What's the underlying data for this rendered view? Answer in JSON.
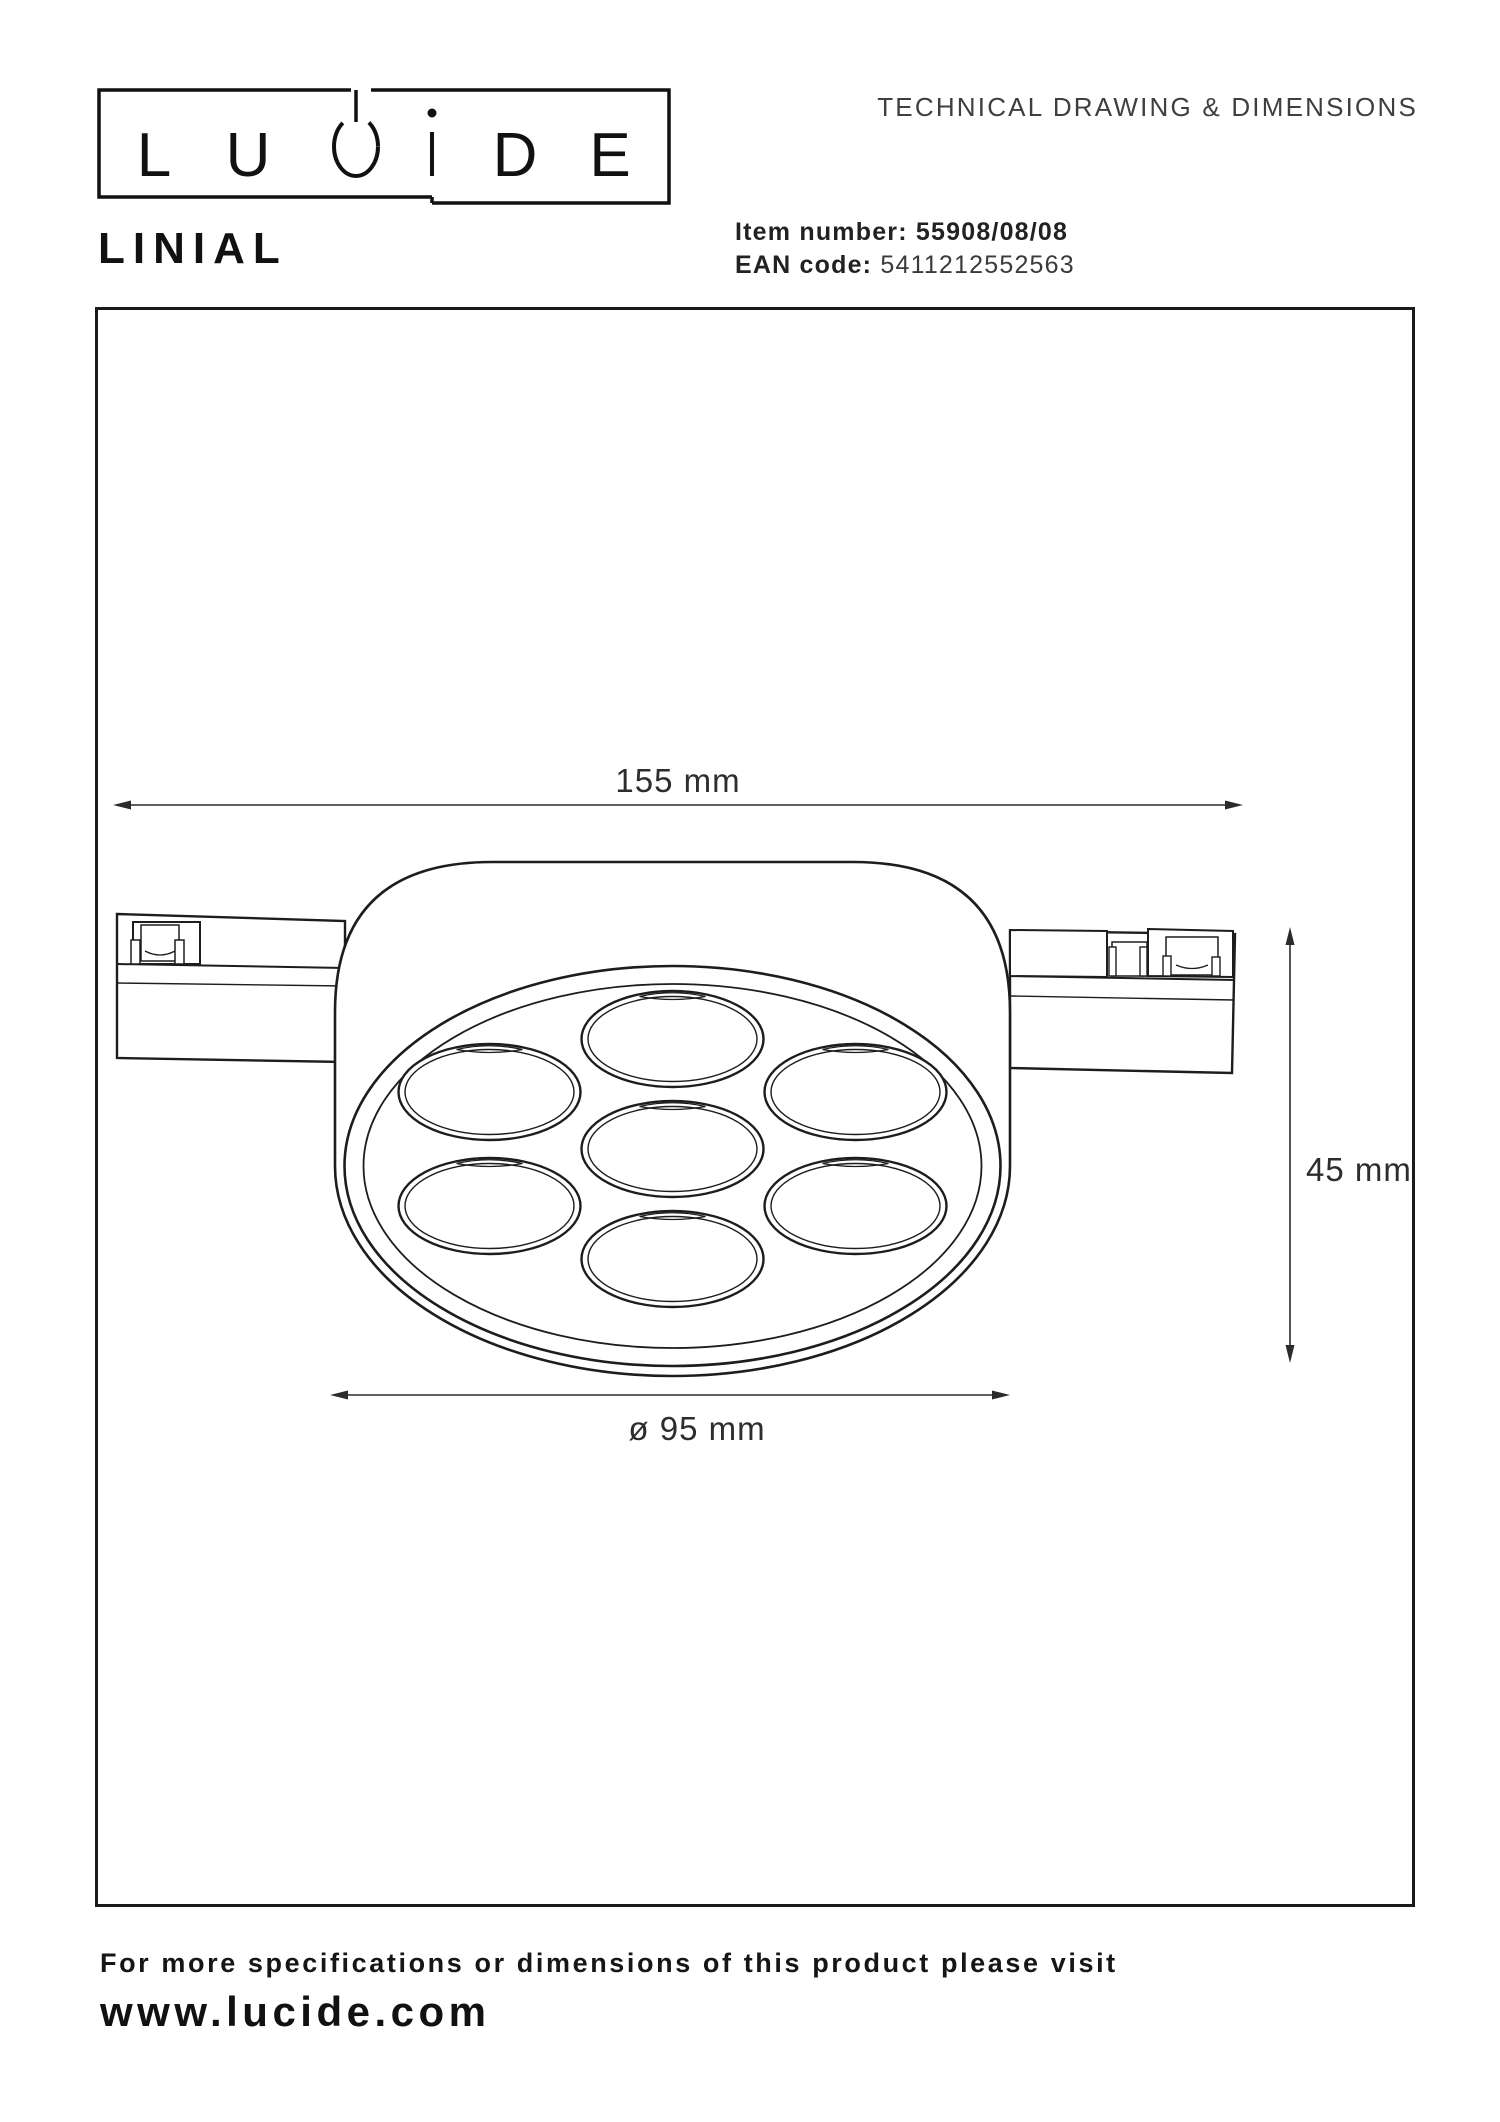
{
  "header": {
    "brand_name": "LUCIDE",
    "logo_letters": [
      "L",
      "U",
      "D",
      "E"
    ],
    "doc_title": "TECHNICAL DRAWING & DIMENSIONS",
    "product_name": "LINIAL",
    "item_number_label": "Item number:",
    "item_number_value": "55908/08/08",
    "ean_label": "EAN code:",
    "ean_value": "5411212552563"
  },
  "drawing": {
    "width_dim": "155 mm",
    "height_dim": "45 mm",
    "diameter_dim": "ø 95 mm"
  },
  "footer": {
    "note": "For more specifications or dimensions of this product please visit",
    "website": "www.lucide.com"
  },
  "colors": {
    "ink": "#1d1d1b",
    "label": "#2d2d2d"
  }
}
